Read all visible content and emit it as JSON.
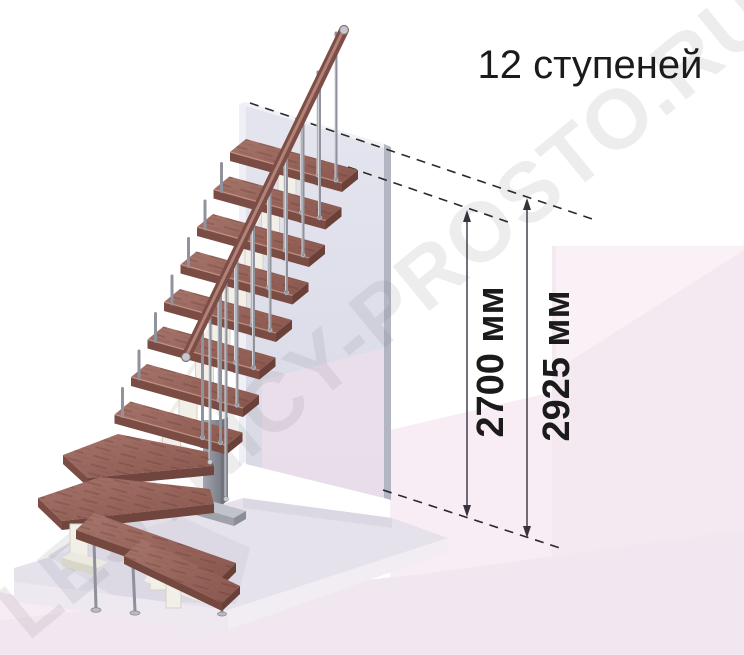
{
  "title": {
    "text": "12 ступеней"
  },
  "watermark": {
    "text": "LESTNICY-PROSTO.RU"
  },
  "annotation": {
    "dim_flight": {
      "label": "2700 мм",
      "value_mm": 2700
    },
    "dim_total": {
      "label": "2925 мм",
      "value_mm": 2925
    }
  },
  "figure": {
    "type": "staircase-isometric-diagram",
    "steps_count": 12,
    "colors": {
      "tread_top": "#9a685e",
      "tread_front": "#7a4c43",
      "handrail": "#7c4e45",
      "metal": "#9a9ca6",
      "stringer": "#f1efe7",
      "wall": "#dfe0ea",
      "wall_edge": "#b4b6c3",
      "floor": "#e5e2ec",
      "background_tint": "#f7ebf3",
      "annotation_ink": "#1b1b1b",
      "watermark": "#73737d"
    }
  }
}
